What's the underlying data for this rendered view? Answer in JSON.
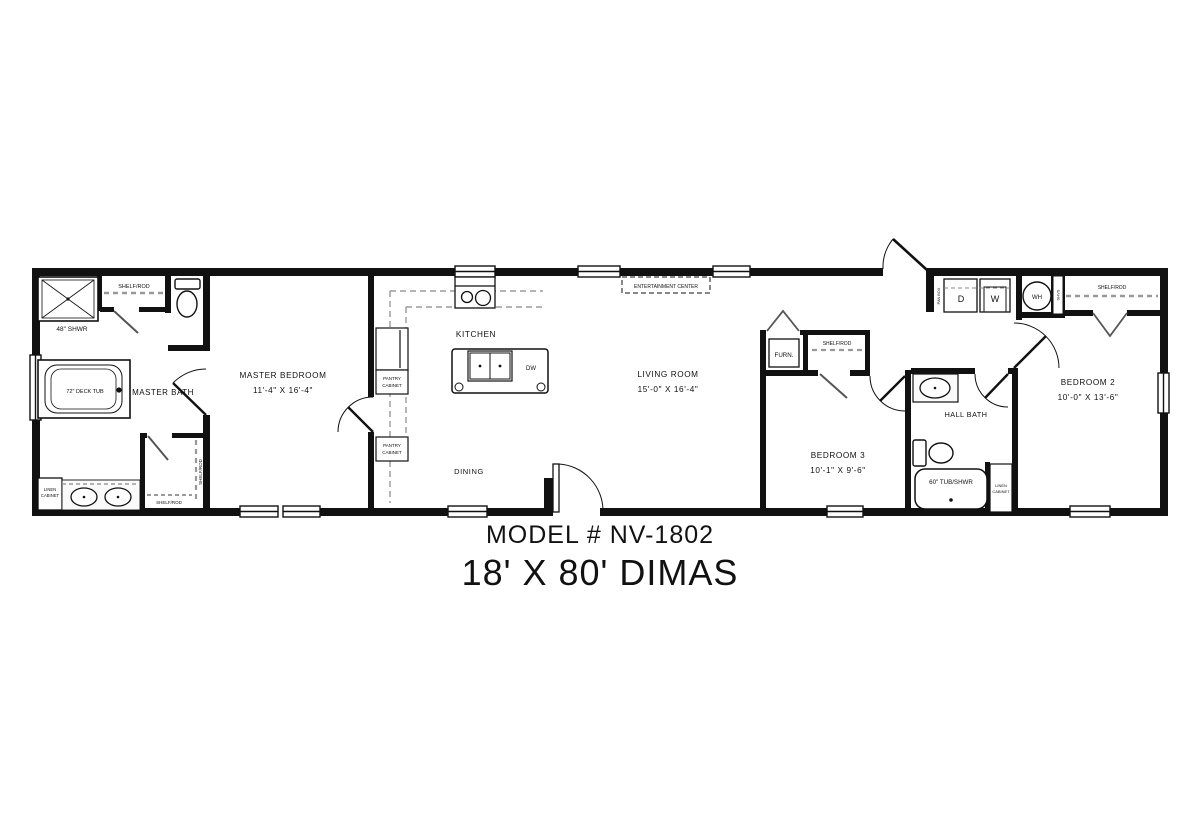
{
  "title": {
    "model": "MODEL # NV-1802",
    "plan": "18' X 80' DIMAS"
  },
  "rooms": {
    "master_bath": "MASTER BATH",
    "master_bedroom": "MASTER BEDROOM",
    "master_bedroom_dims": "11'-4\" X 16'-4\"",
    "kitchen": "KITCHEN",
    "dining": "DINING",
    "living_room": "LIVING ROOM",
    "living_room_dims": "15'-0\" X 16'-4\"",
    "bedroom_3": "BEDROOM 3",
    "bedroom_3_dims": "10'-1\" X 9'-6\"",
    "hall_bath": "HALL BATH",
    "bedroom_2": "BEDROOM 2",
    "bedroom_2_dims": "10'-0\" X 13'-6\""
  },
  "fixtures": {
    "shower": "48\" SHWR",
    "deck_tub": "72\" DECK TUB",
    "tub_shower": "60\" TUB/SHWR",
    "shelf_rod": "SHELF/ROD",
    "linen_1": "LINEN",
    "linen_2": "CABINET",
    "pantry_1": "PANTRY",
    "pantry_2": "CABINET",
    "entertainment_center": "ENTERTAINMENT CENTER",
    "furnace": "FURN.",
    "dryer": "D",
    "washer": "W",
    "water_heater": "WH",
    "dishwasher": "DW",
    "shelves": "SHVS",
    "panel_box": "PAN BOX"
  }
}
